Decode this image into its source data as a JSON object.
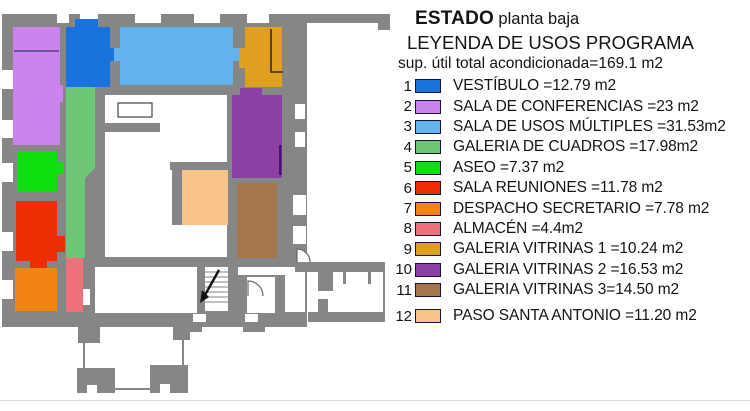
{
  "header": {
    "title_bold": "ESTADO",
    "title_regular": "planta baja",
    "subtitle": "LEYENDA DE USOS PROGRAMA",
    "total_line": "sup. útil total acondicionada=169.1 m2"
  },
  "legend": {
    "items": [
      {
        "num": "1",
        "name": "VESTÍBULO",
        "area_m2": 12.79,
        "label": "VESTÍBULO =12.79 m2",
        "color": "#1a73dd"
      },
      {
        "num": "2",
        "name": "SALA DE CONFERENCIAS",
        "area_m2": 23,
        "label": "SALA DE CONFERENCIAS =23 m2",
        "color": "#cb83ee"
      },
      {
        "num": "3",
        "name": "SALA DE USOS MÚLTIPLES",
        "area_m2": 31.53,
        "label": "SALA DE USOS MÚLTIPLES =31.53m2",
        "color": "#63b3ee"
      },
      {
        "num": "4",
        "name": "GALERIA DE CUADROS",
        "area_m2": 17.98,
        "label": "GALERIA DE CUADROS =17.98m2",
        "color": "#6cc876"
      },
      {
        "num": "5",
        "name": "ASEO",
        "area_m2": 7.37,
        "label": "ASEO =7.37 m2",
        "color": "#0ddf0d"
      },
      {
        "num": "6",
        "name": "SALA REUNIONES",
        "area_m2": 11.78,
        "label": "SALA REUNIONES =11.78 m2",
        "color": "#ed2e04"
      },
      {
        "num": "7",
        "name": "DESPACHO SECRETARIO",
        "area_m2": 7.78,
        "label": "DESPACHO SECRETARIO =7.78 m2",
        "color": "#f28416"
      },
      {
        "num": "8",
        "name": "ALMACÉN",
        "area_m2": 4.4,
        "label": "ALMACÉN =4.4m2",
        "color": "#f0707e"
      },
      {
        "num": "9",
        "name": "GALERIA VITRINAS 1",
        "area_m2": 10.24,
        "label": "GALERIA VITRINAS 1 =10.24 m2",
        "color": "#dfa01f"
      },
      {
        "num": "10",
        "name": "GALERIA VITRINAS 2",
        "area_m2": 16.53,
        "label": "GALERIA VITRINAS 2 =16.53 m2",
        "color": "#8c3fa6"
      },
      {
        "num": "11",
        "name": "GALERIA VITRINAS 3",
        "area_m2": 14.5,
        "label": "GALERIA VITRINAS 3=14.50 m2",
        "color": "#a4764b"
      },
      {
        "num": "12",
        "name": "PASO SANTA ANTONIO",
        "area_m2": 11.2,
        "label": "PASO SANTA ANTONIO =11.20 m2",
        "color": "#f8c489"
      }
    ]
  },
  "plan": {
    "wall_color": "#868686",
    "background_color": "#ffffff",
    "detail_stroke": "#555555"
  }
}
